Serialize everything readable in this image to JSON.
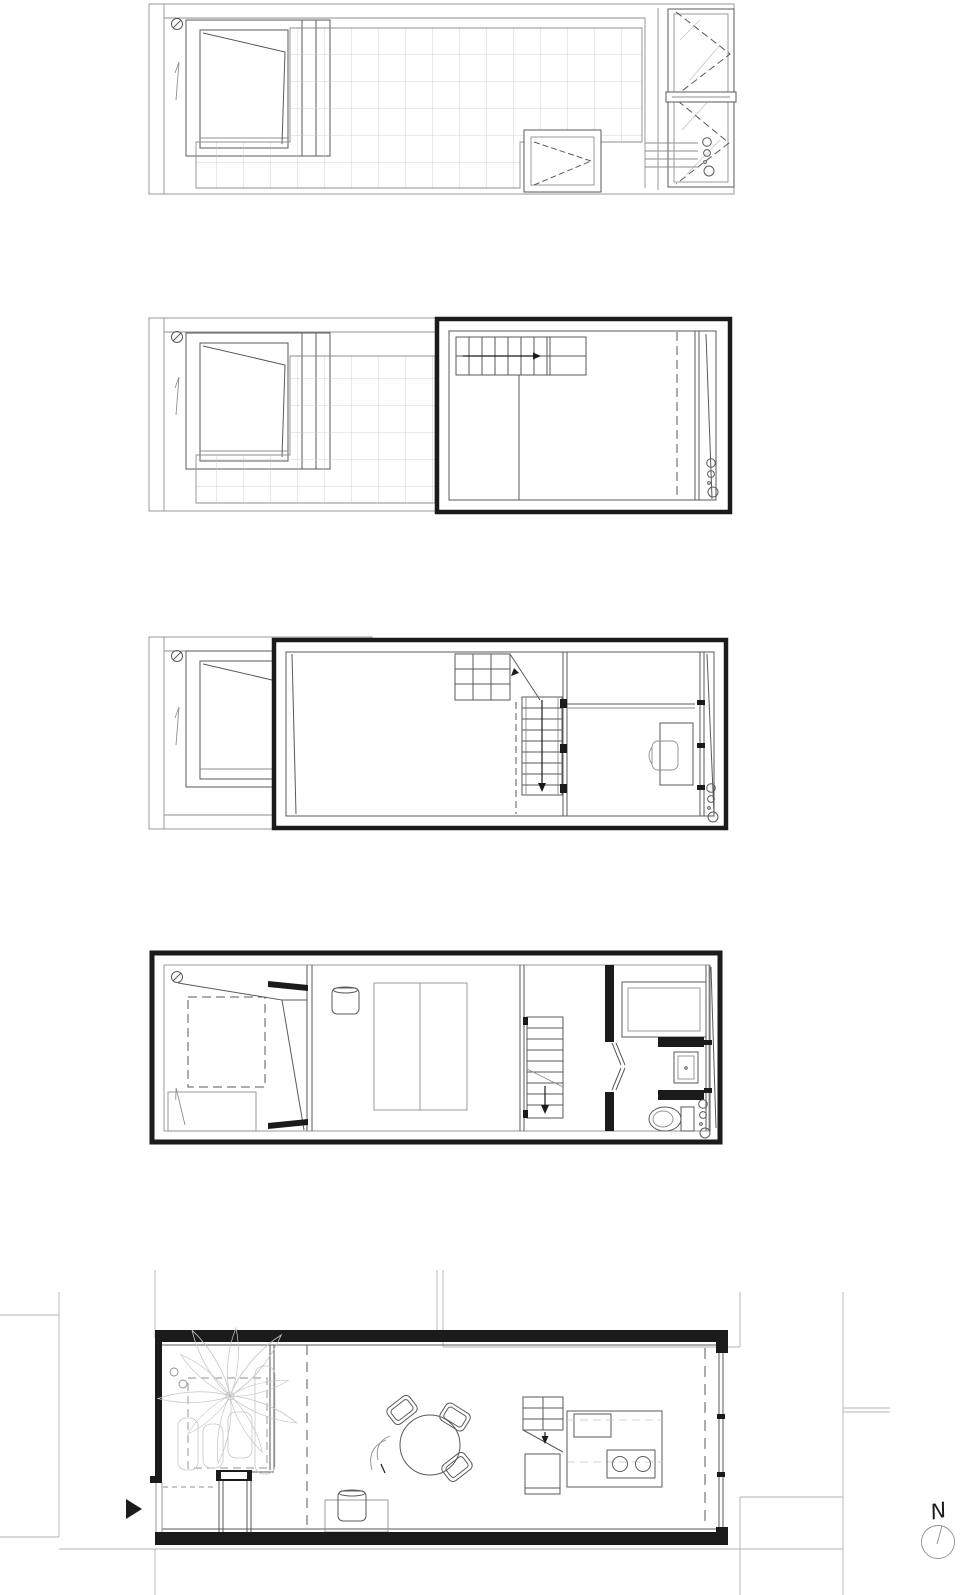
{
  "compass": {
    "label": "N"
  },
  "colors": {
    "paper": "#ffffff",
    "ink": "#1b1b1b",
    "mid": "#5a5a5a",
    "light": "#8f8f8f",
    "faint": "#c5c5c5"
  },
  "plans": [
    {
      "id": "roof-plan"
    },
    {
      "id": "top-floor-plan"
    },
    {
      "id": "middle-floor-plan"
    },
    {
      "id": "bedroom-floor-plan"
    },
    {
      "id": "ground-floor-plan"
    }
  ],
  "icons": {
    "entrance_arrow": "▶",
    "north_compass": "compass-circle-with-needle"
  }
}
